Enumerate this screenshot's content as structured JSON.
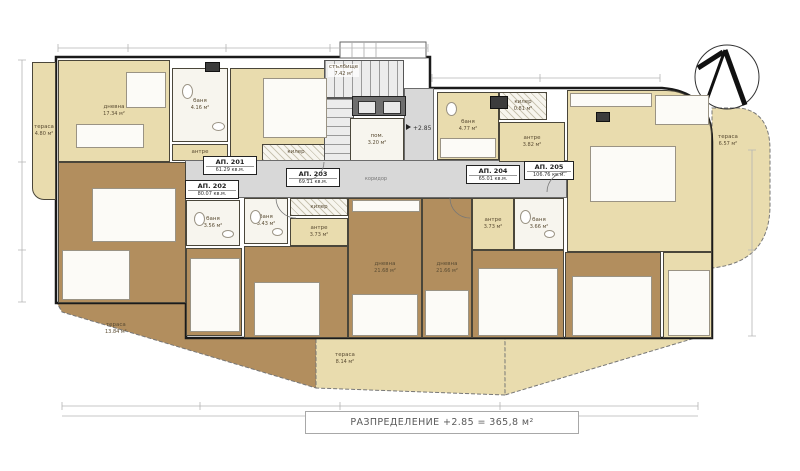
{
  "title_bar": {
    "text": "РАЗПРЕДЕЛЕНИЕ +2.85 = 365,8 м²"
  },
  "level_mark": {
    "value": "+2.85"
  },
  "core": {
    "stairs": {
      "label": "стълбище",
      "area": "7.42 м²"
    },
    "machine_room": {
      "label": "пом.",
      "area": "3.20 м²"
    },
    "corridor_label": "коридор"
  },
  "apartments": [
    {
      "id": "АП. 201",
      "area": "61.29 кв.м."
    },
    {
      "id": "АП. 202",
      "area": "80.07 кв.м."
    },
    {
      "id": "АП. 203",
      "area": "69.11 кв.м."
    },
    {
      "id": "АП. 204",
      "area": "65.01 кв.м."
    },
    {
      "id": "АП. 205",
      "area": "106.76 кв.м."
    }
  ],
  "rooms": [
    {
      "label": "тераса",
      "area": "4.80 м²"
    },
    {
      "label": "дневна",
      "area": "17.34 м²"
    },
    {
      "label": "баня",
      "area": "4.16 м²"
    },
    {
      "label": "спалня",
      "area": "9.74 м²"
    },
    {
      "label": "антре",
      "area": "3.81 м²"
    },
    {
      "label": "килер",
      "area": "1.19 м²"
    },
    {
      "label": "дневна",
      "area": "33.7 м²"
    },
    {
      "label": "баня",
      "area": "3.56 м²"
    },
    {
      "label": "спалня",
      "area": "13.39 м²"
    },
    {
      "label": "тераса",
      "area": "13.84 м²"
    },
    {
      "label": "килер",
      "area": "0.89 м²"
    },
    {
      "label": "баня",
      "area": "3.43 м²"
    },
    {
      "label": "антре",
      "area": "3.73 м²"
    },
    {
      "label": "дневна",
      "area": "21.68 м²"
    },
    {
      "label": "спалня",
      "area": "11.28 м²"
    },
    {
      "label": "тераса",
      "area": "8.14 м²"
    },
    {
      "label": "дневна",
      "area": "21.66 м²"
    },
    {
      "label": "антре",
      "area": "3.73 м²"
    },
    {
      "label": "баня",
      "area": "3.66 м²"
    },
    {
      "label": "спалня",
      "area": "17.08 м²"
    },
    {
      "label": "баня",
      "area": "4.77 м²"
    },
    {
      "label": "килер",
      "area": "0.81 м²"
    },
    {
      "label": "антре",
      "area": "3.82 м²"
    },
    {
      "label": "дневна",
      "area": "39.31 м²"
    },
    {
      "label": "спалня",
      "area": "16.11 м²"
    },
    {
      "label": "спалня",
      "area": "11.42 м²"
    },
    {
      "label": "тераса",
      "area": "6.57 м²"
    }
  ],
  "colors": {
    "beige": "#e9dcae",
    "brown": "#b28e5e",
    "grey": "#d8d8d8",
    "wall": "#1a1a1a"
  }
}
